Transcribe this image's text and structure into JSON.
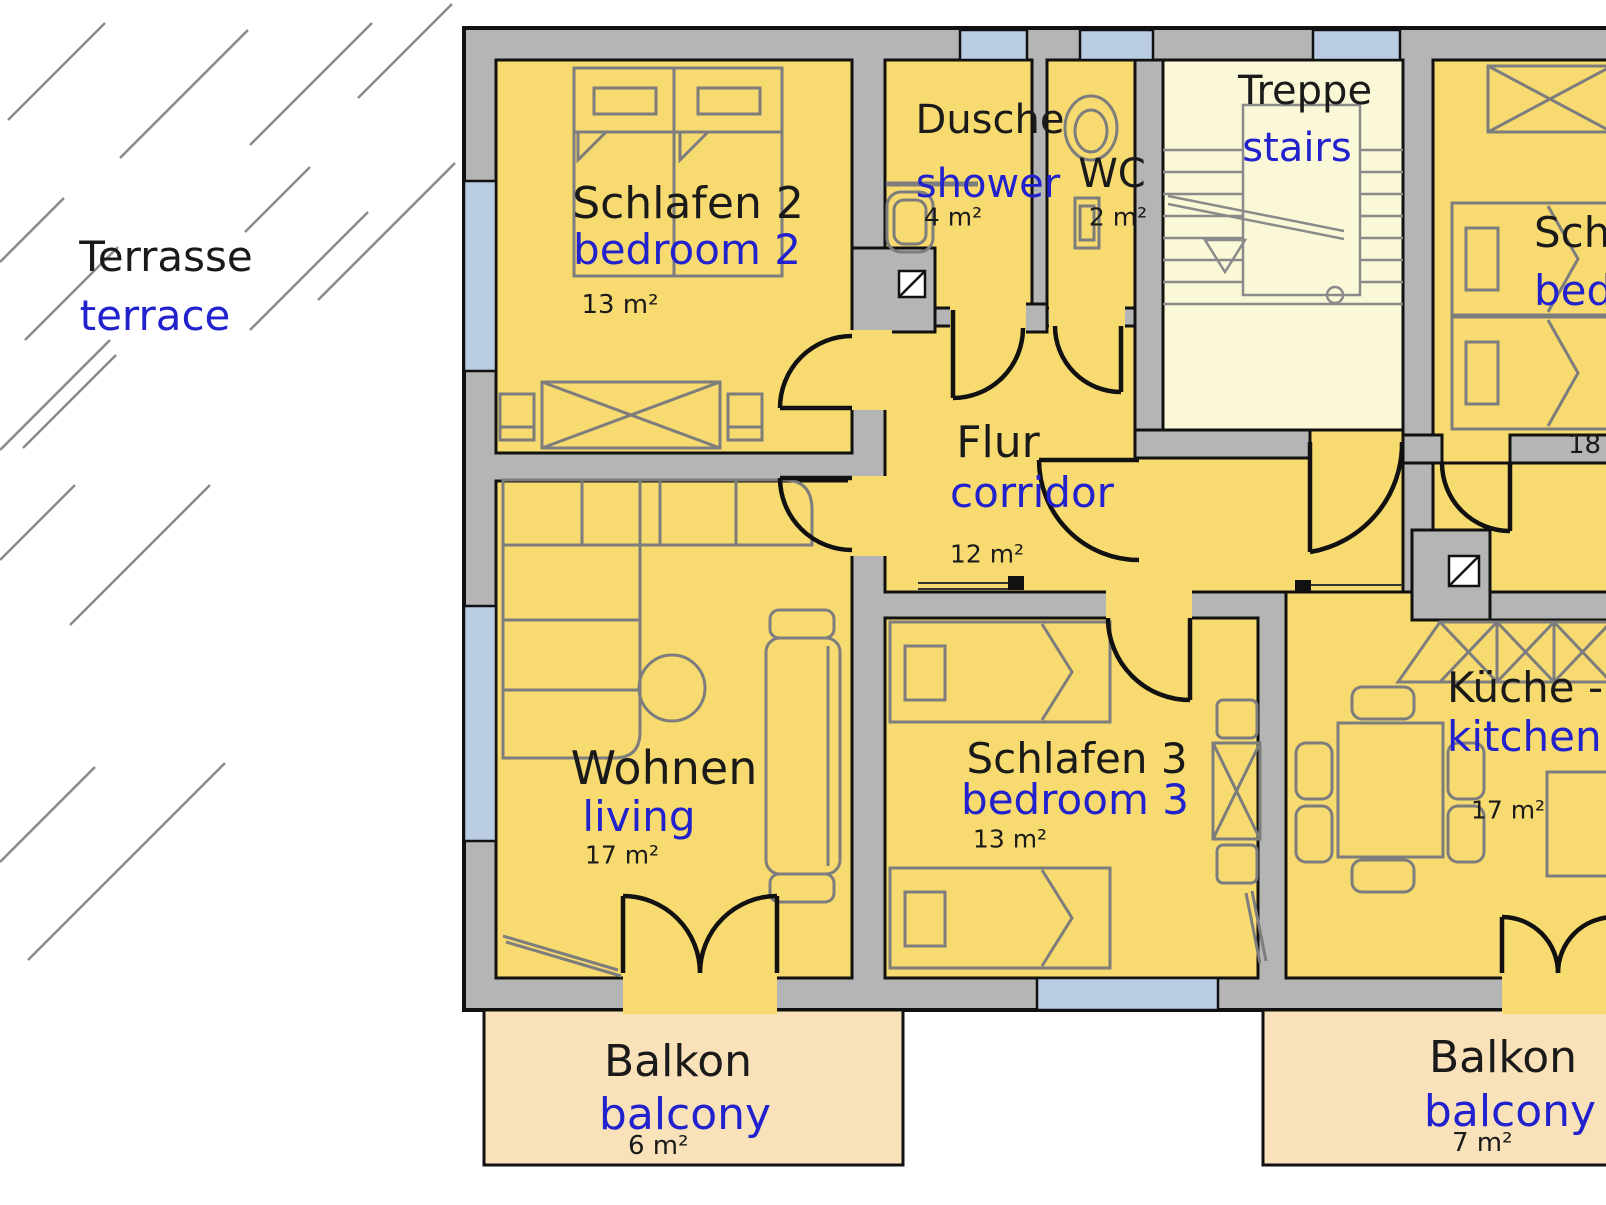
{
  "title": "Apartment floor plan (upper floor) with bilingual room labels",
  "colors": {
    "room_fill": "#f8db70",
    "stair_room_fill": "#fbf8d8",
    "balcony_fill": "#f9e2ba",
    "wall_fill": "#b5b5b5",
    "window_fill": "#b9cce4",
    "outline": "#111111",
    "furniture_stroke": "#7d7d7d",
    "label_primary": "#1a1a1a",
    "label_secondary": "#2121cd"
  },
  "labels": {
    "terrace": {
      "de": "Terrasse",
      "en": "terrace"
    },
    "bedroom2": {
      "de": "Schlafen 2",
      "en": "bedroom 2",
      "area": "13 m²"
    },
    "shower": {
      "de": "Dusche",
      "en": "shower",
      "area": "4 m²"
    },
    "wc": {
      "de": "WC",
      "area": "2 m²"
    },
    "stairs": {
      "de": "Treppe",
      "en": "stairs"
    },
    "bedroom1": {
      "de": "Schlafen 1",
      "en": "bedroom 1",
      "area": "18 m²"
    },
    "corridor": {
      "de": "Flur",
      "en": "corridor",
      "area": "12 m²"
    },
    "living": {
      "de": "Wohnen",
      "en": "living",
      "area": "17 m²"
    },
    "bedroom3": {
      "de": "Schlafen 3",
      "en": "bedroom 3",
      "area": "13 m²"
    },
    "kitchen": {
      "de": "Küche -",
      "en": "kitchen",
      "area": "17 m²"
    },
    "balcony_left": {
      "de": "Balkon",
      "en": "balcony",
      "area": "6 m²"
    },
    "balcony_right": {
      "de": "Balkon",
      "en": "balcony",
      "area": "7 m²"
    }
  }
}
